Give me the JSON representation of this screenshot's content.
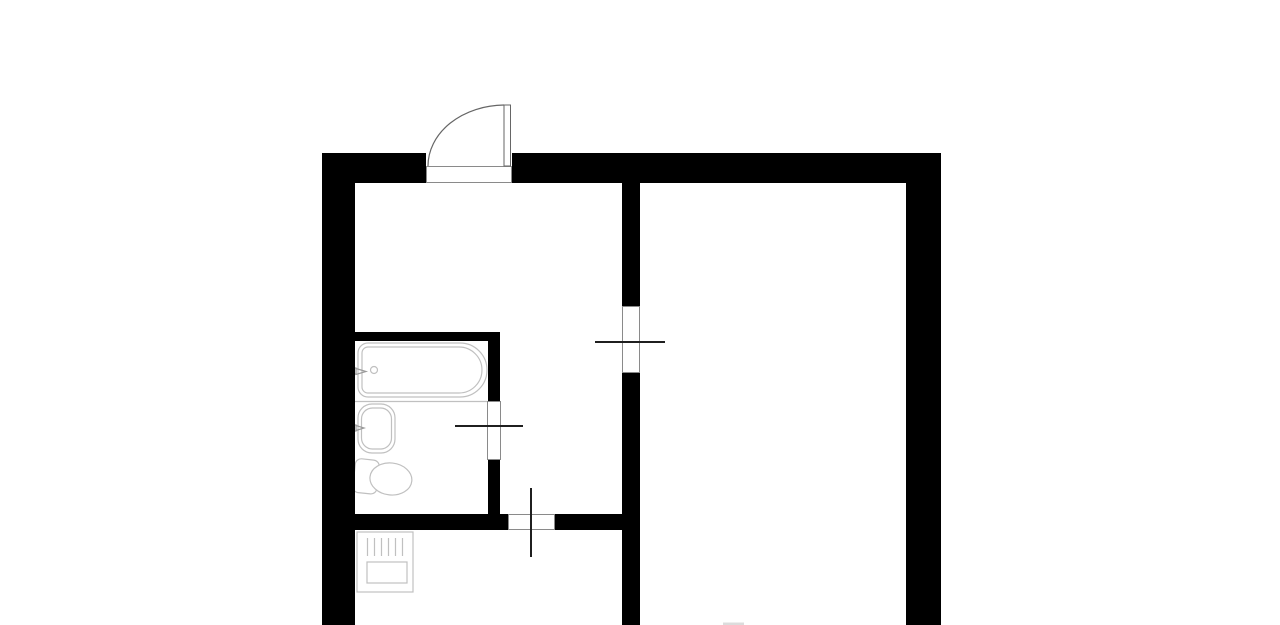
{
  "plan": {
    "canvas": {
      "w": 1280,
      "h": 625,
      "background": "#ffffff"
    },
    "colors": {
      "wall": "#000000",
      "jamb": "#8a8a8a",
      "door": "#1f1f1f",
      "door_frame": "#666666",
      "fixture": "#c0c0c0",
      "fixture_dark": "#9a9a9a",
      "hint": "#dcdcdc",
      "background": "#ffffff"
    },
    "walls": [
      {
        "name": "top-wall-left",
        "x": 322,
        "y": 153,
        "w": 104,
        "h": 30
      },
      {
        "name": "top-wall-right",
        "x": 512,
        "y": 153,
        "w": 429,
        "h": 30
      },
      {
        "name": "left-wall",
        "x": 322,
        "y": 153,
        "w": 33,
        "h": 472
      },
      {
        "name": "right-wall",
        "x": 906,
        "y": 153,
        "w": 35,
        "h": 472
      },
      {
        "name": "divider-wall-upper",
        "x": 622,
        "y": 180,
        "w": 18,
        "h": 126
      },
      {
        "name": "divider-wall-lower",
        "x": 622,
        "y": 373,
        "w": 18,
        "h": 252
      },
      {
        "name": "bathroom-top-wall",
        "x": 354,
        "y": 332,
        "w": 146,
        "h": 9
      },
      {
        "name": "bathroom-right-wall-upper",
        "x": 488,
        "y": 332,
        "w": 12,
        "h": 69
      },
      {
        "name": "bathroom-right-wall-lower",
        "x": 488,
        "y": 460,
        "w": 12,
        "h": 70
      },
      {
        "name": "kitchen-wall-left",
        "x": 354,
        "y": 514,
        "w": 154,
        "h": 16
      },
      {
        "name": "kitchen-wall-right",
        "x": 555,
        "y": 514,
        "w": 68,
        "h": 16
      }
    ],
    "door_openings": [
      {
        "name": "entrance-threshold",
        "x": 426,
        "y": 166,
        "w": 86,
        "h": 17
      },
      {
        "name": "room-door-jamb",
        "x": 622,
        "y": 306,
        "w": 18,
        "h": 67
      },
      {
        "name": "bathroom-door-jamb",
        "x": 487,
        "y": 401,
        "w": 14,
        "h": 59
      },
      {
        "name": "kitchen-door-jamb",
        "x": 508,
        "y": 514,
        "w": 47,
        "h": 16
      }
    ],
    "door_leaves": [
      {
        "name": "room-door-leaf",
        "x1": 595,
        "y1": 342,
        "x2": 665,
        "y2": 342
      },
      {
        "name": "bathroom-door-leaf",
        "x1": 455,
        "y1": 426,
        "x2": 523,
        "y2": 426
      },
      {
        "name": "kitchen-door-leaf",
        "x1": 531,
        "y1": 488,
        "x2": 531,
        "y2": 557
      }
    ],
    "entrance_door": {
      "leaf": {
        "name": "entrance-door-leaf",
        "x": 504,
        "y": 105,
        "w": 6.5,
        "h": 61
      },
      "arc": {
        "name": "entrance-door-arc",
        "d": "M 428 166 A 77 61 0 0 1 504 105"
      }
    },
    "fixtures": [
      {
        "name": "bathtub-outline",
        "type": "path",
        "d": "M 368 343 H 460 A 27 27 0 0 1 460 397 H 368 A 10 10 0 0 1 358 387 V 353 A 10 10 0 0 1 368 343 Z",
        "stroke": "fixture",
        "fill": "#ffffff"
      },
      {
        "name": "bathtub-inner",
        "type": "path",
        "d": "M 368 347 H 459 A 23 23 0 0 1 459 393 H 368 A 6 6 0 0 1 362 387 V 353 A 6 6 0 0 1 368 347 Z",
        "stroke": "fixture",
        "fill": "none"
      },
      {
        "name": "bathtub-drain",
        "type": "circle",
        "cx": 374,
        "cy": 370,
        "r": 3.5,
        "stroke": "fixture",
        "fill": "none"
      },
      {
        "name": "bathtub-tap",
        "type": "path",
        "d": "M 352 368 h 4 v 6 h -4 Z M 356 368.5 L 366 371.5 L 356 374.5 Z",
        "stroke": "fixture_dark",
        "fill": "none"
      },
      {
        "name": "bathroom-partition-line",
        "type": "line",
        "x1": 355,
        "y1": 401.5,
        "x2": 487,
        "y2": 401.5,
        "stroke": "fixture"
      },
      {
        "name": "sink-outline",
        "type": "rect",
        "x": 358,
        "y": 404,
        "w": 37,
        "h": 49,
        "r": 14,
        "stroke": "fixture",
        "fill": "#ffffff"
      },
      {
        "name": "sink-basin",
        "type": "rect",
        "x": 361.5,
        "y": 408,
        "w": 30,
        "h": 41,
        "r": 11,
        "stroke": "fixture",
        "fill": "none"
      },
      {
        "name": "sink-tap",
        "type": "path",
        "d": "M 352 425 h 4 v 6 h -4 Z M 356 425.5 L 364 428 L 356 430.5 Z",
        "stroke": "fixture_dark",
        "fill": "none"
      },
      {
        "name": "toilet-tank",
        "type": "rect",
        "x": 354,
        "y": 460,
        "w": 24,
        "h": 34,
        "r": 6,
        "stroke": "fixture",
        "fill": "#ffffff",
        "transform": "rotate(6 372 477)"
      },
      {
        "name": "toilet-bowl",
        "type": "ellipse",
        "cx": 391,
        "cy": 477,
        "rx": 21,
        "ry": 16,
        "stroke": "fixture",
        "fill": "#ffffff",
        "transform": "rotate(6 372 477)"
      },
      {
        "name": "stove-outline",
        "type": "rect",
        "x": 357,
        "y": 532,
        "w": 56,
        "h": 60,
        "r": 0,
        "stroke": "fixture",
        "fill": "#ffffff"
      },
      {
        "name": "stove-grill-lines",
        "type": "path",
        "d": "M 367.5 538 V 556 M 374.5 538 V 556 M 381.5 538 V 556 M 388.5 538 V 556 M 395.5 538 V 556 M 402.5 538 V 556",
        "stroke": "fixture",
        "fill": "none"
      },
      {
        "name": "stove-drawer",
        "type": "rect",
        "x": 367,
        "y": 562,
        "w": 40,
        "h": 21,
        "r": 0,
        "stroke": "fixture",
        "fill": "none"
      },
      {
        "name": "window-hint",
        "type": "rect",
        "x": 723,
        "y": 622.5,
        "w": 21,
        "h": 2.5,
        "r": 0,
        "stroke": "none",
        "fill": "#dcdcdc"
      }
    ]
  }
}
